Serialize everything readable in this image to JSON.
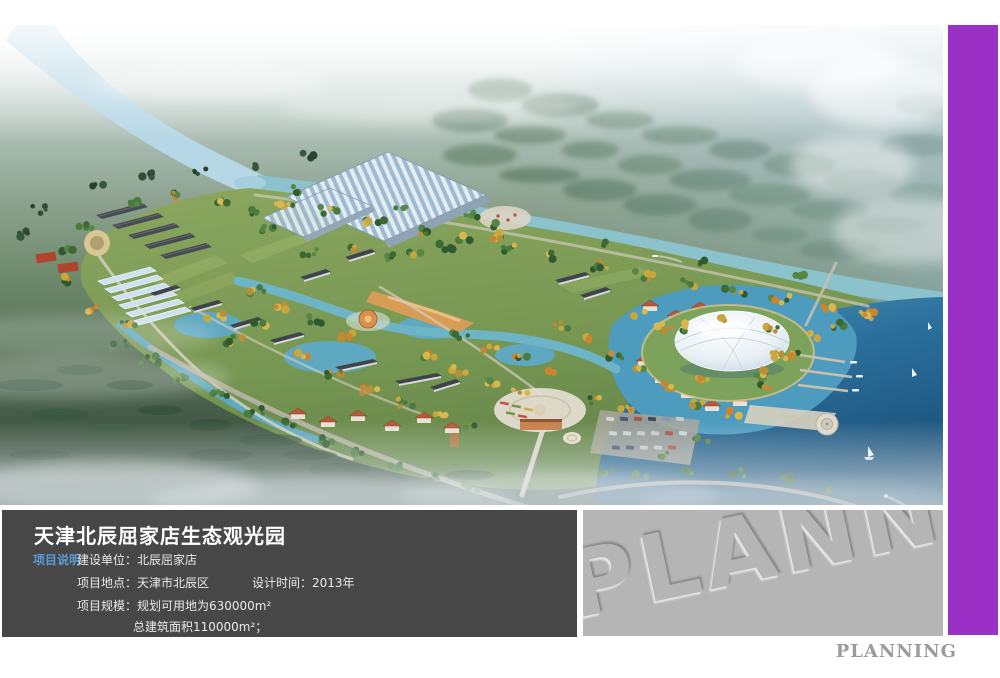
{
  "colors": {
    "purple_bar": "#9a30c6",
    "info_panel_bg": "#474747",
    "watermark_panel_bg": "#b5b5b5",
    "watermark_text": "#b5b5b5",
    "section_label_blue": "#5b9bd5",
    "footer_gray": "#9b9b9b"
  },
  "info_panel": {
    "title": "天津北辰屈家店生态观光园",
    "section_label": "项目说明",
    "construction_unit": "建设单位：北辰屈家店",
    "location": "项目地点：天津市北辰区",
    "design_time": "设计时间：2013年",
    "scale": "项目规模：规划可用地为630000m²",
    "total_area": "总建筑面积110000m²；"
  },
  "watermark": {
    "text": "PLANNING"
  },
  "footer": {
    "text": "PLANNING"
  }
}
